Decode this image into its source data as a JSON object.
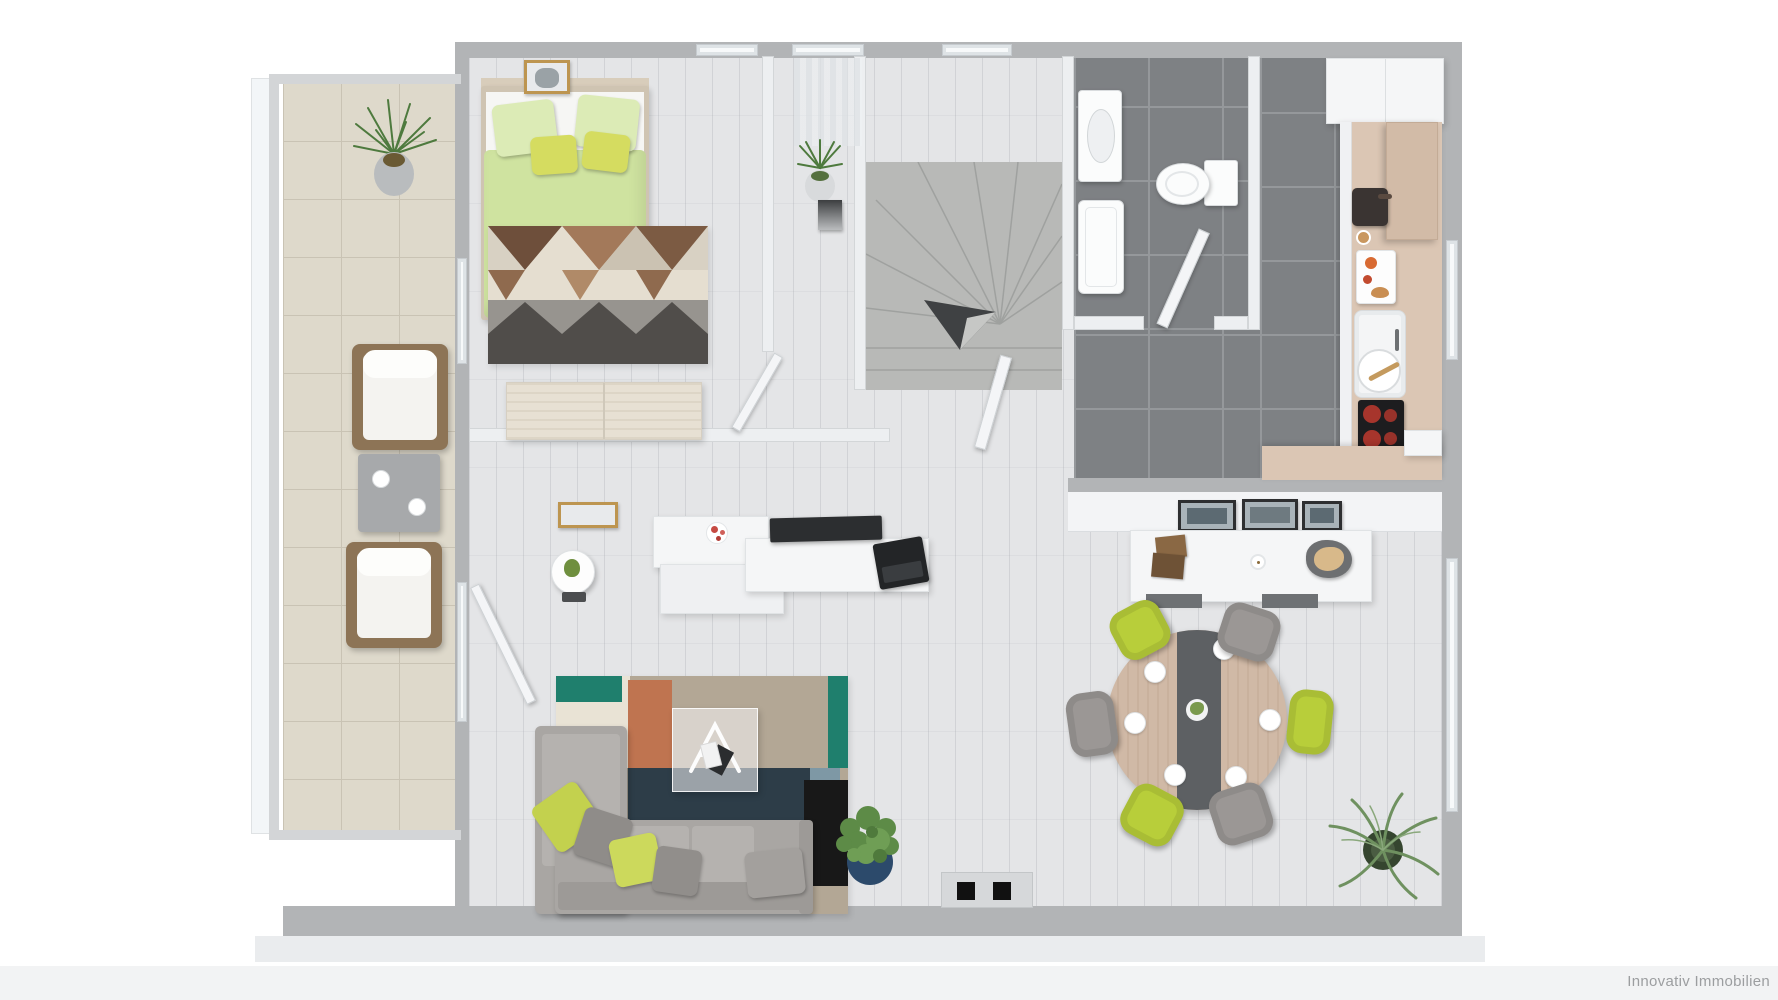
{
  "watermark": {
    "text": "Innovativ Immobilien"
  },
  "colors": {
    "wall": "#b2b4b6",
    "iwall": "#edeff1",
    "iwall-edge": "#d3d6d8",
    "wood": "#e4e5e7",
    "tile": "#7e8184",
    "tile-line": "#95989b",
    "balcony-tile": "#ded9cb",
    "balcony-line": "#c9c3b4",
    "stairs": "#b8b9b7",
    "duvet-green": "#cfe3a0",
    "pillow-green": "#dcebb6",
    "pillow-yellow": "#d5dc60",
    "lime": "#b8ce3a",
    "gray-chair": "#9b9795",
    "sofa": "#a9a6a3",
    "sofa-light": "#b5b2af",
    "sofa-dark": "#9d9a97",
    "wood-furniture": "#e7e0d3",
    "bed-wood": "#cfc4b2",
    "counter-wood": "#dbc6b4",
    "cabinet-wood": "#d2bba7",
    "table-wood": "#d0b9a6",
    "table-stripe": "#5d6063",
    "rug-teal": "#1f7f6d",
    "rug-orange": "#bf7450",
    "rug-taupe": "#b3a795",
    "rug-navy": "#2d3d48",
    "rug-black": "#181818",
    "rug-cream": "#e9e3d5",
    "plant-green": "#5e8b4f",
    "palm-green": "#6f9160",
    "pot-blue": "#2c4a6b",
    "white-furniture": "#f5f6f7",
    "dark-screen": "#2c2e30",
    "hob-black": "#1d1d1f",
    "burner-red": "#c0392f",
    "door-panel": "#d6d8da",
    "page-strip": "#f2f3f4",
    "watermark": "#9c9ea0"
  }
}
